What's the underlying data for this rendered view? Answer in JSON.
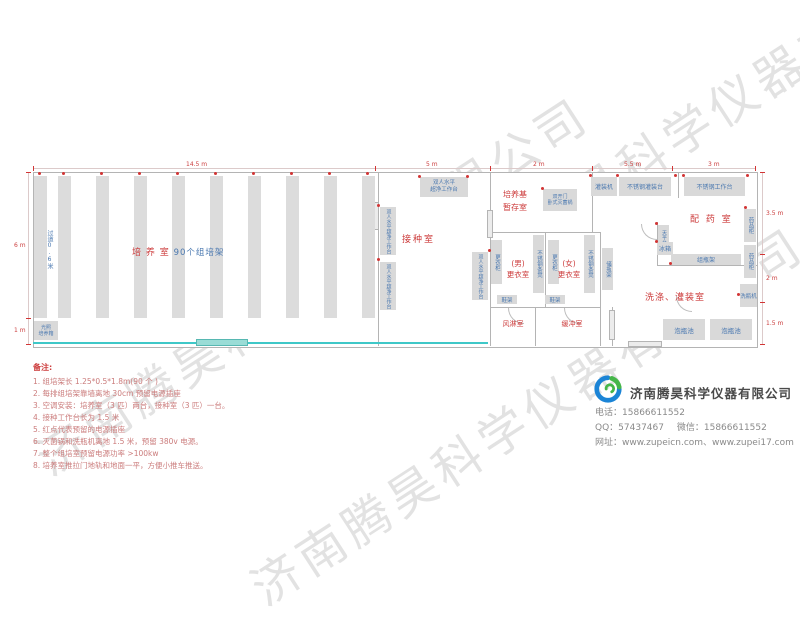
{
  "watermark": {
    "text": "济南腾昊科学仪器有限公司"
  },
  "dims": {
    "top": [
      "14.5 m",
      "5 m",
      "2 m",
      "5.5 m",
      "3 m"
    ],
    "left": [
      "6 m",
      "1 m"
    ],
    "right": [
      "3.5 m",
      "2 m",
      "1.5 m"
    ]
  },
  "rooms": {
    "culture": {
      "name_red": "培 养 室",
      "name_blue": "90个组培架",
      "aisle": "过道0.6米",
      "incubator_line1": "光照",
      "incubator_line2": "培养箱"
    },
    "inoculation": {
      "name": "接种室",
      "bench_full": "双人水平超净工作台",
      "bench_line1": "双人水平",
      "bench_line2": "超净工作台"
    },
    "medium_storage": {
      "name_line1": "培养基",
      "name_line2": "暂存室",
      "sterilizer_line1": "双开门",
      "sterilizer_line2": "卧式灭菌锅"
    },
    "changing_male": {
      "name_line1": "(男)",
      "name_line2": "更衣室",
      "locker": "更衣柜",
      "bench": "不锈钢条凳",
      "shoe_rack": "鞋架"
    },
    "changing_female": {
      "name_line1": "(女)",
      "name_line2": "更衣室",
      "locker": "更衣柜",
      "bench": "不锈钢条凳",
      "shoe_rack": "鞋架"
    },
    "air_shower": {
      "name": "风淋室"
    },
    "buffer": {
      "name": "缓冲室"
    },
    "corridor": {
      "bottle_rack": "储瓶架"
    },
    "preparation": {
      "name": "配 药 室",
      "filling_machine": "灌装机",
      "filling_table": "不锈钢灌装台",
      "work_table": "不锈钢工作台",
      "balance_table": "天平台",
      "fridge": "冰箱",
      "medicine_cabinet1": "药品柜",
      "medicine_cabinet2": "药品柜",
      "bottle_rack": "组瓶架"
    },
    "washing": {
      "name": "洗涤、灌装室",
      "bottle_washer": "洗瓶机",
      "soak_pool1": "泡瓶池",
      "soak_pool2": "泡瓶池"
    }
  },
  "notes": {
    "title": "备注:",
    "items": [
      "1.  组培架长 1.25*0.5*1.8m(90 个 )",
      "2.  每排组培架靠墙离地 30cm 预留电源插座",
      "3.  空调安装：培养室（3 匹）两台，接种室（3 匹）一台。",
      "4.  接种工作台长为 1.5 米",
      "5.  红点代表预留的电源插座",
      "6.  灭菌锅和洗瓶机离地 1.5 米，预留 380v 电源。",
      "7.  整个组培室预留电源功率 >100kw",
      "8.  培养室推拉门地轨和地面一平，方便小推车推送。"
    ]
  },
  "company": {
    "name": "济南腾昊科学仪器有限公司",
    "phone_label": "电话：",
    "phone": "15866611552",
    "qq_label": "QQ：",
    "qq": "57437467",
    "wechat_label": "微信：",
    "wechat": "15866611552",
    "web_label": "网址：",
    "web": "www.zupeicn.com、www.zupei17.com"
  },
  "colors": {
    "label_blue": "#4a78b0",
    "label_red": "#cc3b3b",
    "furniture_gray": "#d9d9d9",
    "wall_gray": "#b4b4b4",
    "front_glass_cyan": "#3fc8c8",
    "logo_blue": "#1b84d6",
    "logo_green": "#45b649"
  }
}
